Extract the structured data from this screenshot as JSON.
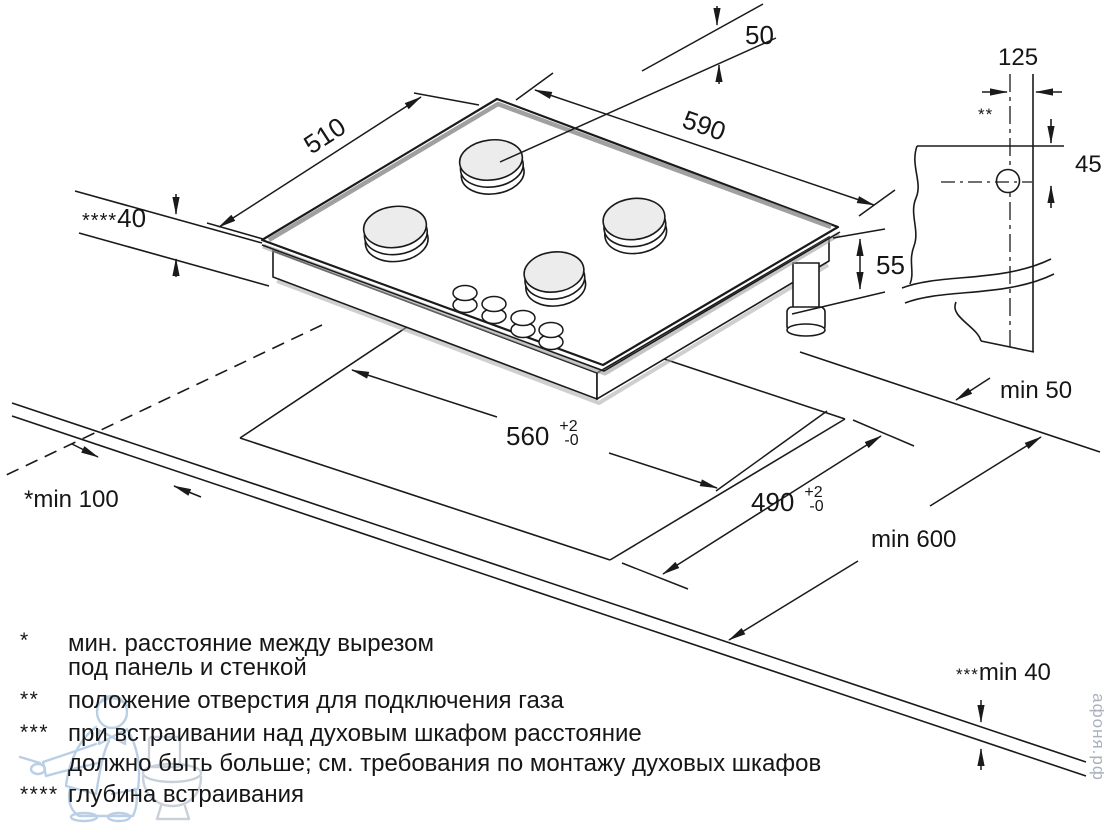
{
  "colors": {
    "line": "#1a1a1a",
    "burner_fill": "#ececec",
    "bevel_gray": "#8f8f8f",
    "shadow_gray": "#9e9e9e",
    "mascot_blue": "#b7cde4",
    "toilet_gray": "#c6ced9",
    "watermark_text": "#a9b2bc",
    "background": "#ffffff"
  },
  "dims": {
    "panel_width": "590",
    "panel_depth": "510",
    "burner_to_edge": "50",
    "embed_depth_marker": "****",
    "embed_depth": "40",
    "body_height": "55",
    "gas_offset_x": "125",
    "gas_offset_y": "45",
    "gas_hole_marker": "**",
    "cutout_width": "560",
    "cutout_width_tol_plus": "+2",
    "cutout_width_tol_minus": "-0",
    "cutout_depth": "490",
    "cutout_depth_tol_plus": "+2",
    "cutout_depth_tol_minus": "-0",
    "rear_clearance": "min 50",
    "worktop_depth": "min 600",
    "side_clearance": "*min 100",
    "oven_gap_marker": "***",
    "oven_gap": "min 40"
  },
  "legend": {
    "items": [
      {
        "marker": "*",
        "line1": "мин. расстояние между вырезом",
        "line2": "под панель и стенкой"
      },
      {
        "marker": "**",
        "line1": "положение отверстия для подключения газа",
        "line2": ""
      },
      {
        "marker": "***",
        "line1": "при встраивании над духовым шкафом расстояние",
        "line2": "должно быть больше; см. требования по монтажу духовых шкафов"
      },
      {
        "marker": "****",
        "line1": "глубина встраивания",
        "line2": ""
      }
    ]
  },
  "watermark": {
    "site": "афоня.рф"
  }
}
